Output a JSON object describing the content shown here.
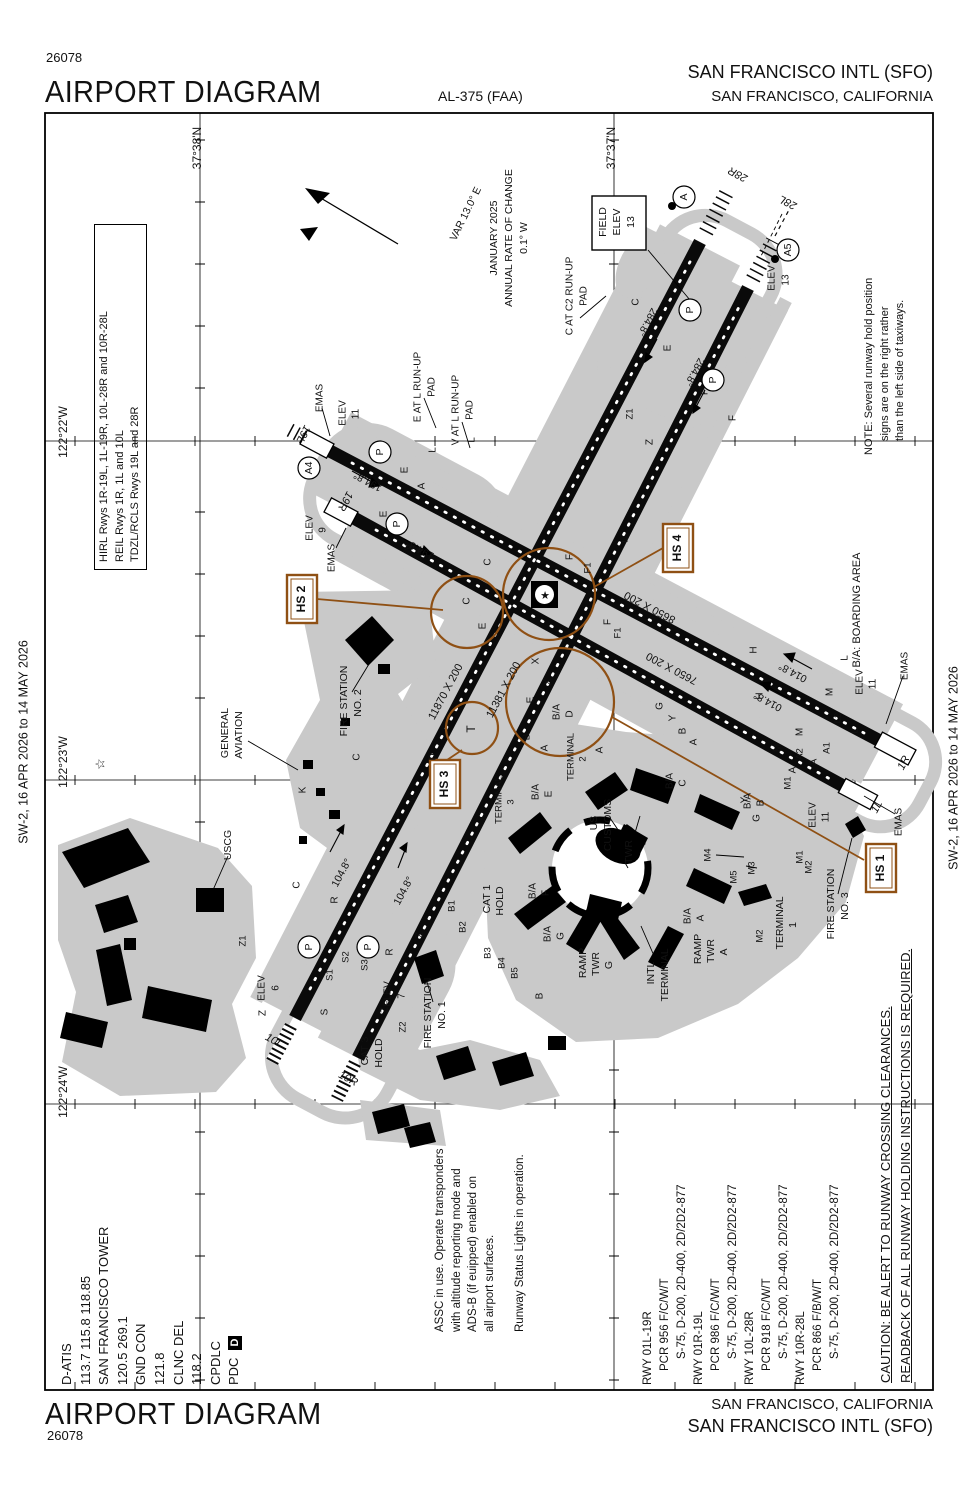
{
  "header": {
    "chart_number": "26078",
    "title": "AIRPORT DIAGRAM",
    "al_number": "AL-375 (FAA)",
    "airport_name": "SAN FRANCISCO INTL (SFO)",
    "city": "SAN FRANCISCO, CALIFORNIA"
  },
  "footer": {
    "title": "AIRPORT DIAGRAM",
    "chart_number": "26078",
    "city": "SAN FRANCISCO, CALIFORNIA",
    "airport_name": "SAN FRANCISCO INTL (SFO)"
  },
  "frequencies": {
    "lines": [
      "D-ATIS",
      "113.7  115.8  118.85",
      "SAN FRANCISCO TOWER",
      "120.5  269.1",
      "GND CON",
      "121.8",
      "CLNC DEL",
      "118.2",
      "CPDLC",
      "PDC"
    ]
  },
  "pdc_box": {
    "label": "D"
  },
  "lighting": {
    "lines": [
      "HIRL Rwys 1R-19L, 1L-19R, 10L-28R and 10R-28L",
      "REIL Rwys 1R, 1L and 10L",
      "TDZL/RCLS Rwys 19L and 28R"
    ]
  },
  "note": {
    "lines": [
      "NOTE: Several runway hold position",
      "signs are on the right rather",
      "than the left side of taxiways."
    ]
  },
  "assc": {
    "lines": [
      "ASSC in use. Operate transponders",
      "with altitude reporting mode and",
      "ADS-B (if euipped) enabled on",
      "all airport surfaces."
    ],
    "rwsl": "Runway Status Lights in operation."
  },
  "caution": {
    "lines": [
      "CAUTION: BE ALERT TO RUNWAY CROSSING CLEARANCES.",
      "READBACK OF ALL RUNWAY HOLDING INSTRUCTIONS IS REQUIRED."
    ]
  },
  "runway_data": {
    "rows": [
      {
        "rwy": "RWY 01L-19R",
        "pcr": "PCR 956 F/C/W/T",
        "s": "S-75, D-200, 2D-400, 2D/2D2-877"
      },
      {
        "rwy": "RWY 01R-19L",
        "pcr": "PCR 986 F/C/W/T",
        "s": "S-75, D-200, 2D-400, 2D/2D2-877"
      },
      {
        "rwy": "RWY 10L-28R",
        "pcr": "PCR 918 F/C/W/T",
        "s": "S-75, D-200, 2D-400, 2D/2D2-877"
      },
      {
        "rwy": "RWY 10R-28L",
        "pcr": "PCR 866 F/B/W/T",
        "s": "S-75, D-200, 2D-400, 2D/2D2-877"
      }
    ]
  },
  "hotspots": {
    "hs1": "HS 1",
    "hs2": "HS 2",
    "hs3": "HS 3",
    "hs4": "HS 4"
  },
  "colors": {
    "hotspot_brown": "#8f5014",
    "taxiway_gray": "#c9c9c9"
  },
  "diagram": {
    "labels": [
      {
        "t": "SW-2,  16 APR 2026  to  14 MAY 2026",
        "x": 24,
        "y": 742,
        "s": 12.5
      },
      {
        "t": "SW-2,  16 APR 2026  to  14 MAY 2026",
        "x": 954,
        "y": 768,
        "s": 12.5
      },
      {
        "t": "37°38'N",
        "x": 198,
        "y": 148,
        "s": 12
      },
      {
        "t": "37°37'N",
        "x": 612,
        "y": 148,
        "s": 12
      },
      {
        "t": "122°22'W",
        "x": 64,
        "y": 432,
        "s": 12
      },
      {
        "t": "122°23'W",
        "x": 64,
        "y": 762,
        "s": 12
      },
      {
        "t": "122°24'W",
        "x": 64,
        "y": 1092,
        "s": 12
      },
      {
        "t": "VAR 13.0° E",
        "x": 466,
        "y": 214,
        "r": -64,
        "s": 10.5
      },
      {
        "t": "JANUARY 2025",
        "x": 494,
        "y": 238,
        "s": 10.5
      },
      {
        "t": "ANNUAL RATE OF CHANGE",
        "x": 509,
        "y": 238,
        "s": 10.5
      },
      {
        "t": "0.1° W",
        "x": 524,
        "y": 238,
        "s": 10.5
      },
      {
        "t": "FIELD",
        "x": 603,
        "y": 222,
        "s": 10.5
      },
      {
        "t": "ELEV",
        "x": 617,
        "y": 222,
        "s": 10.5
      },
      {
        "t": "13",
        "x": 631,
        "y": 222,
        "s": 10.5
      },
      {
        "t": "C AT C2 RUN-UP",
        "x": 570,
        "y": 296,
        "s": 10
      },
      {
        "t": "PAD",
        "x": 584,
        "y": 296,
        "s": 10
      },
      {
        "t": "E AT L RUN-UP",
        "x": 418,
        "y": 387,
        "s": 10
      },
      {
        "t": "PAD",
        "x": 432,
        "y": 387,
        "s": 10
      },
      {
        "t": "V AT L RUN-UP",
        "x": 456,
        "y": 410,
        "s": 10
      },
      {
        "t": "PAD",
        "x": 470,
        "y": 410,
        "s": 10
      },
      {
        "t": "EMAS",
        "x": 320,
        "y": 398,
        "s": 10
      },
      {
        "t": "ELEV",
        "x": 343,
        "y": 413,
        "s": 10
      },
      {
        "t": "11",
        "x": 356,
        "y": 414,
        "s": 10
      },
      {
        "t": "ELEV",
        "x": 310,
        "y": 528,
        "s": 10
      },
      {
        "t": "9",
        "x": 323,
        "y": 530,
        "s": 10
      },
      {
        "t": "EMAS",
        "x": 332,
        "y": 558,
        "s": 10
      },
      {
        "t": "EMAS",
        "x": 905,
        "y": 666,
        "s": 10
      },
      {
        "t": "ELEV",
        "x": 860,
        "y": 682,
        "s": 10
      },
      {
        "t": "11",
        "x": 873,
        "y": 684,
        "s": 10
      },
      {
        "t": "ELEV",
        "x": 813,
        "y": 815,
        "s": 10
      },
      {
        "t": "11",
        "x": 826,
        "y": 817,
        "s": 10
      },
      {
        "t": "EMAS",
        "x": 899,
        "y": 822,
        "s": 10
      },
      {
        "t": "ELEV",
        "x": 262,
        "y": 988,
        "s": 10
      },
      {
        "t": "6",
        "x": 276,
        "y": 988,
        "s": 10
      },
      {
        "t": "ELEV",
        "x": 388,
        "y": 994,
        "s": 10
      },
      {
        "t": "7",
        "x": 402,
        "y": 996,
        "s": 10
      },
      {
        "t": "ELEV",
        "x": 772,
        "y": 278,
        "s": 10
      },
      {
        "t": "13",
        "x": 786,
        "y": 280,
        "s": 10
      },
      {
        "t": "19L",
        "x": 303,
        "y": 434,
        "r": 118,
        "s": 11,
        "i": 1
      },
      {
        "t": "19R",
        "x": 345,
        "y": 501,
        "r": 118,
        "s": 11,
        "i": 1
      },
      {
        "t": "1R",
        "x": 904,
        "y": 763,
        "r": -62,
        "s": 11,
        "i": 1
      },
      {
        "t": "1L",
        "x": 877,
        "y": 807,
        "r": -62,
        "s": 11,
        "i": 1
      },
      {
        "t": "10L",
        "x": 274,
        "y": 1041,
        "r": 28,
        "s": 11,
        "i": 1
      },
      {
        "t": "10R",
        "x": 348,
        "y": 1079,
        "r": 28,
        "s": 11,
        "i": 1
      },
      {
        "t": "28R",
        "x": 738,
        "y": 174,
        "r": -152,
        "s": 11,
        "i": 1
      },
      {
        "t": "28L",
        "x": 788,
        "y": 202,
        "r": -152,
        "s": 11,
        "i": 1
      },
      {
        "t": "11870 X 200",
        "x": 446,
        "y": 692,
        "r": -62,
        "s": 11
      },
      {
        "t": "11381 X 200",
        "x": 504,
        "y": 690,
        "r": -62,
        "s": 11
      },
      {
        "t": "8650 X 200",
        "x": 650,
        "y": 607,
        "r": 208,
        "s": 11
      },
      {
        "t": "7650 X 200",
        "x": 672,
        "y": 668,
        "r": 208,
        "s": 11
      },
      {
        "t": "194.8°",
        "x": 368,
        "y": 481,
        "r": 208,
        "s": 10.5
      },
      {
        "t": "194.8°",
        "x": 420,
        "y": 549,
        "r": 208,
        "s": 10.5
      },
      {
        "t": "014.8°",
        "x": 793,
        "y": 672,
        "r": 208,
        "s": 10.5
      },
      {
        "t": "014.8°",
        "x": 768,
        "y": 701,
        "r": 208,
        "s": 10.5
      },
      {
        "t": "104.8°",
        "x": 342,
        "y": 873,
        "r": -62,
        "s": 10.5
      },
      {
        "t": "104.8°",
        "x": 404,
        "y": 891,
        "r": -62,
        "s": 10.5
      },
      {
        "t": "284.8°",
        "x": 647,
        "y": 322,
        "r": 118,
        "s": 10.5
      },
      {
        "t": "284.8°",
        "x": 694,
        "y": 372,
        "r": 118,
        "s": 10.5
      },
      {
        "t": "GENERAL",
        "x": 225,
        "y": 733,
        "s": 10.5
      },
      {
        "t": "AVIATION",
        "x": 239,
        "y": 735,
        "s": 10.5
      },
      {
        "t": "USCG",
        "x": 228,
        "y": 845,
        "s": 10.5
      },
      {
        "t": "FIRE STATION",
        "x": 344,
        "y": 701,
        "s": 10.5
      },
      {
        "t": "NO. 2",
        "x": 358,
        "y": 703,
        "s": 10.5
      },
      {
        "t": "FIRE STATION",
        "x": 428,
        "y": 1013,
        "s": 10.5
      },
      {
        "t": "NO. 1",
        "x": 442,
        "y": 1015,
        "s": 10.5
      },
      {
        "t": "FIRE STATION",
        "x": 831,
        "y": 904,
        "s": 10.5
      },
      {
        "t": "NO. 3",
        "x": 845,
        "y": 906,
        "s": 10.5
      },
      {
        "t": "CAT 3",
        "x": 365,
        "y": 1051,
        "s": 10.5
      },
      {
        "t": "HOLD",
        "x": 379,
        "y": 1053,
        "s": 10.5
      },
      {
        "t": "CAT 1",
        "x": 487,
        "y": 899,
        "s": 10.5
      },
      {
        "t": "HOLD",
        "x": 500,
        "y": 901,
        "s": 10.5
      },
      {
        "t": "US",
        "x": 594,
        "y": 823,
        "s": 10.5
      },
      {
        "t": "CUSTOMS",
        "x": 608,
        "y": 825,
        "s": 10.5
      },
      {
        "t": "TWR",
        "x": 629,
        "y": 852,
        "s": 10.5
      },
      {
        "t": "INTL",
        "x": 651,
        "y": 973,
        "s": 10.5
      },
      {
        "t": "TERMINAL",
        "x": 665,
        "y": 975,
        "s": 10.5
      },
      {
        "t": "RAMP",
        "x": 583,
        "y": 963,
        "s": 10.5
      },
      {
        "t": "TWR",
        "x": 596,
        "y": 964,
        "s": 10.5
      },
      {
        "t": "G",
        "x": 609,
        "y": 965,
        "s": 10.5
      },
      {
        "t": "RAMP",
        "x": 698,
        "y": 949,
        "s": 10.5
      },
      {
        "t": "TWR",
        "x": 711,
        "y": 951,
        "s": 10.5
      },
      {
        "t": "A",
        "x": 724,
        "y": 952,
        "s": 10.5
      },
      {
        "t": "TERMINAL",
        "x": 780,
        "y": 923,
        "s": 10.5
      },
      {
        "t": "1",
        "x": 793,
        "y": 925,
        "s": 10.5
      },
      {
        "t": "TERMINAL",
        "x": 571,
        "y": 757,
        "s": 9.5
      },
      {
        "t": "2",
        "x": 583,
        "y": 759,
        "s": 9.5
      },
      {
        "t": "TERMINAL",
        "x": 499,
        "y": 800,
        "s": 9.5
      },
      {
        "t": "3",
        "x": 511,
        "y": 802,
        "s": 9.5
      },
      {
        "t": "B/A: BOARDING AREA",
        "x": 857,
        "y": 610,
        "s": 11
      },
      {
        "t": "M4",
        "x": 708,
        "y": 855,
        "s": 9.5
      },
      {
        "t": "M3",
        "x": 752,
        "y": 868,
        "s": 9.5
      },
      {
        "t": "M5",
        "x": 734,
        "y": 877,
        "s": 9.5
      },
      {
        "t": "M1",
        "x": 800,
        "y": 857,
        "s": 9.5
      },
      {
        "t": "M2",
        "x": 809,
        "y": 867,
        "s": 9.5
      },
      {
        "t": "M2",
        "x": 760,
        "y": 936,
        "s": 9.5
      },
      {
        "t": "M1",
        "x": 788,
        "y": 783,
        "s": 9.5
      },
      {
        "t": "B/A",
        "x": 670,
        "y": 781,
        "s": 10
      },
      {
        "t": "C",
        "x": 683,
        "y": 783,
        "s": 10
      },
      {
        "t": "B/A",
        "x": 748,
        "y": 801,
        "s": 10
      },
      {
        "t": "B",
        "x": 761,
        "y": 803,
        "s": 10
      },
      {
        "t": "B/A",
        "x": 688,
        "y": 916,
        "s": 10
      },
      {
        "t": "A",
        "x": 701,
        "y": 918,
        "s": 10
      },
      {
        "t": "B/A",
        "x": 557,
        "y": 712,
        "s": 10
      },
      {
        "t": "D",
        "x": 570,
        "y": 714,
        "s": 10
      },
      {
        "t": "B/A",
        "x": 536,
        "y": 792,
        "s": 10
      },
      {
        "t": "E",
        "x": 549,
        "y": 794,
        "s": 10
      },
      {
        "t": "B/A",
        "x": 533,
        "y": 891,
        "s": 10
      },
      {
        "t": "F",
        "x": 546,
        "y": 893,
        "s": 10
      },
      {
        "t": "B/A",
        "x": 548,
        "y": 934,
        "s": 10
      },
      {
        "t": "G",
        "x": 561,
        "y": 936,
        "s": 10
      },
      {
        "t": "E",
        "x": 405,
        "y": 470,
        "s": 10
      },
      {
        "t": "A",
        "x": 422,
        "y": 486,
        "s": 10
      },
      {
        "t": "L",
        "x": 433,
        "y": 450,
        "s": 10
      },
      {
        "t": "E",
        "x": 384,
        "y": 514,
        "s": 10
      },
      {
        "t": "V",
        "x": 409,
        "y": 547,
        "s": 10
      },
      {
        "t": "L",
        "x": 472,
        "y": 440,
        "s": 10
      },
      {
        "t": "C",
        "x": 636,
        "y": 302,
        "s": 10
      },
      {
        "t": "E",
        "x": 668,
        "y": 348,
        "s": 10
      },
      {
        "t": "F",
        "x": 705,
        "y": 392,
        "s": 10
      },
      {
        "t": "Z1",
        "x": 630,
        "y": 414,
        "s": 9.5
      },
      {
        "t": "Z",
        "x": 650,
        "y": 442,
        "s": 10
      },
      {
        "t": "F",
        "x": 733,
        "y": 418,
        "s": 10
      },
      {
        "t": "C",
        "x": 488,
        "y": 562,
        "s": 10
      },
      {
        "t": "C",
        "x": 467,
        "y": 601,
        "s": 10
      },
      {
        "t": "E",
        "x": 483,
        "y": 626,
        "s": 10
      },
      {
        "t": "D",
        "x": 433,
        "y": 757,
        "s": 10
      },
      {
        "t": "C",
        "x": 357,
        "y": 757,
        "s": 10
      },
      {
        "t": "K",
        "x": 303,
        "y": 790,
        "s": 10
      },
      {
        "t": "K",
        "x": 414,
        "y": 797,
        "s": 10
      },
      {
        "t": "T",
        "x": 472,
        "y": 729,
        "s": 12
      },
      {
        "t": "F",
        "x": 570,
        "y": 557,
        "s": 10
      },
      {
        "t": "F1",
        "x": 588,
        "y": 568,
        "s": 9.5
      },
      {
        "t": "L",
        "x": 625,
        "y": 540,
        "s": 10
      },
      {
        "t": "F",
        "x": 608,
        "y": 622,
        "s": 10
      },
      {
        "t": "F1",
        "x": 618,
        "y": 633,
        "s": 9.5
      },
      {
        "t": "X",
        "x": 548,
        "y": 682,
        "s": 10
      },
      {
        "t": "X",
        "x": 536,
        "y": 661,
        "s": 10
      },
      {
        "t": "E",
        "x": 531,
        "y": 700,
        "s": 10
      },
      {
        "t": "B",
        "x": 527,
        "y": 737,
        "s": 10
      },
      {
        "t": "A",
        "x": 545,
        "y": 748,
        "s": 10
      },
      {
        "t": "G",
        "x": 660,
        "y": 706,
        "s": 10
      },
      {
        "t": "Y",
        "x": 673,
        "y": 718,
        "s": 10
      },
      {
        "t": "B",
        "x": 683,
        "y": 731,
        "s": 10
      },
      {
        "t": "A",
        "x": 694,
        "y": 742,
        "s": 10
      },
      {
        "t": "H",
        "x": 754,
        "y": 650,
        "s": 10
      },
      {
        "t": "H",
        "x": 760,
        "y": 696,
        "s": 10
      },
      {
        "t": "M",
        "x": 830,
        "y": 692,
        "s": 10
      },
      {
        "t": "M",
        "x": 800,
        "y": 732,
        "s": 10
      },
      {
        "t": "M",
        "x": 778,
        "y": 748,
        "s": 10
      },
      {
        "t": "L2",
        "x": 838,
        "y": 718,
        "s": 9.5
      },
      {
        "t": "L",
        "x": 855,
        "y": 731,
        "s": 10
      },
      {
        "t": "L",
        "x": 845,
        "y": 658,
        "s": 10
      },
      {
        "t": "A2",
        "x": 800,
        "y": 754,
        "s": 9.5
      },
      {
        "t": "A1",
        "x": 827,
        "y": 748,
        "s": 9.5
      },
      {
        "t": "A",
        "x": 793,
        "y": 770,
        "s": 10
      },
      {
        "t": "A",
        "x": 814,
        "y": 762,
        "s": 10
      },
      {
        "t": "Y",
        "x": 745,
        "y": 800,
        "s": 10
      },
      {
        "t": "G",
        "x": 757,
        "y": 818,
        "s": 10
      },
      {
        "t": "Z",
        "x": 420,
        "y": 935,
        "s": 10
      },
      {
        "t": "R",
        "x": 390,
        "y": 952,
        "s": 10
      },
      {
        "t": "R",
        "x": 335,
        "y": 900,
        "s": 10
      },
      {
        "t": "C",
        "x": 297,
        "y": 885,
        "s": 10
      },
      {
        "t": "S3",
        "x": 365,
        "y": 965,
        "s": 9.5
      },
      {
        "t": "S2",
        "x": 346,
        "y": 957,
        "s": 9.5
      },
      {
        "t": "S1",
        "x": 330,
        "y": 975,
        "s": 9.5
      },
      {
        "t": "S",
        "x": 325,
        "y": 1012,
        "s": 10
      },
      {
        "t": "Z",
        "x": 385,
        "y": 1010,
        "s": 10
      },
      {
        "t": "Z2",
        "x": 403,
        "y": 1027,
        "s": 9.5
      },
      {
        "t": "Z",
        "x": 263,
        "y": 1013,
        "s": 10
      },
      {
        "t": "Z1",
        "x": 243,
        "y": 941,
        "s": 9.5
      },
      {
        "t": "B1",
        "x": 452,
        "y": 906,
        "s": 9.5
      },
      {
        "t": "B2",
        "x": 463,
        "y": 927,
        "s": 9.5
      },
      {
        "t": "B3",
        "x": 488,
        "y": 953,
        "s": 9.5
      },
      {
        "t": "B4",
        "x": 502,
        "y": 963,
        "s": 9.5
      },
      {
        "t": "B5",
        "x": 515,
        "y": 973,
        "s": 9.5
      },
      {
        "t": "B",
        "x": 540,
        "y": 996,
        "s": 10
      },
      {
        "t": "A",
        "x": 600,
        "y": 750,
        "s": 10
      },
      {
        "t": "★",
        "x": 545,
        "y": 596,
        "r": 0,
        "s": 11
      },
      {
        "t": "☆",
        "x": 101,
        "y": 764,
        "s": 13
      }
    ],
    "circled": [
      {
        "t": "A4",
        "x": 309,
        "y": 468
      },
      {
        "t": "P",
        "x": 380,
        "y": 452
      },
      {
        "t": "P",
        "x": 397,
        "y": 524
      },
      {
        "t": "P",
        "x": 690,
        "y": 310
      },
      {
        "t": "P",
        "x": 713,
        "y": 380
      },
      {
        "t": "A",
        "x": 684,
        "y": 197
      },
      {
        "t": "A5",
        "x": 788,
        "y": 250
      },
      {
        "t": "P",
        "x": 309,
        "y": 947
      },
      {
        "t": "P",
        "x": 368,
        "y": 947
      }
    ]
  }
}
